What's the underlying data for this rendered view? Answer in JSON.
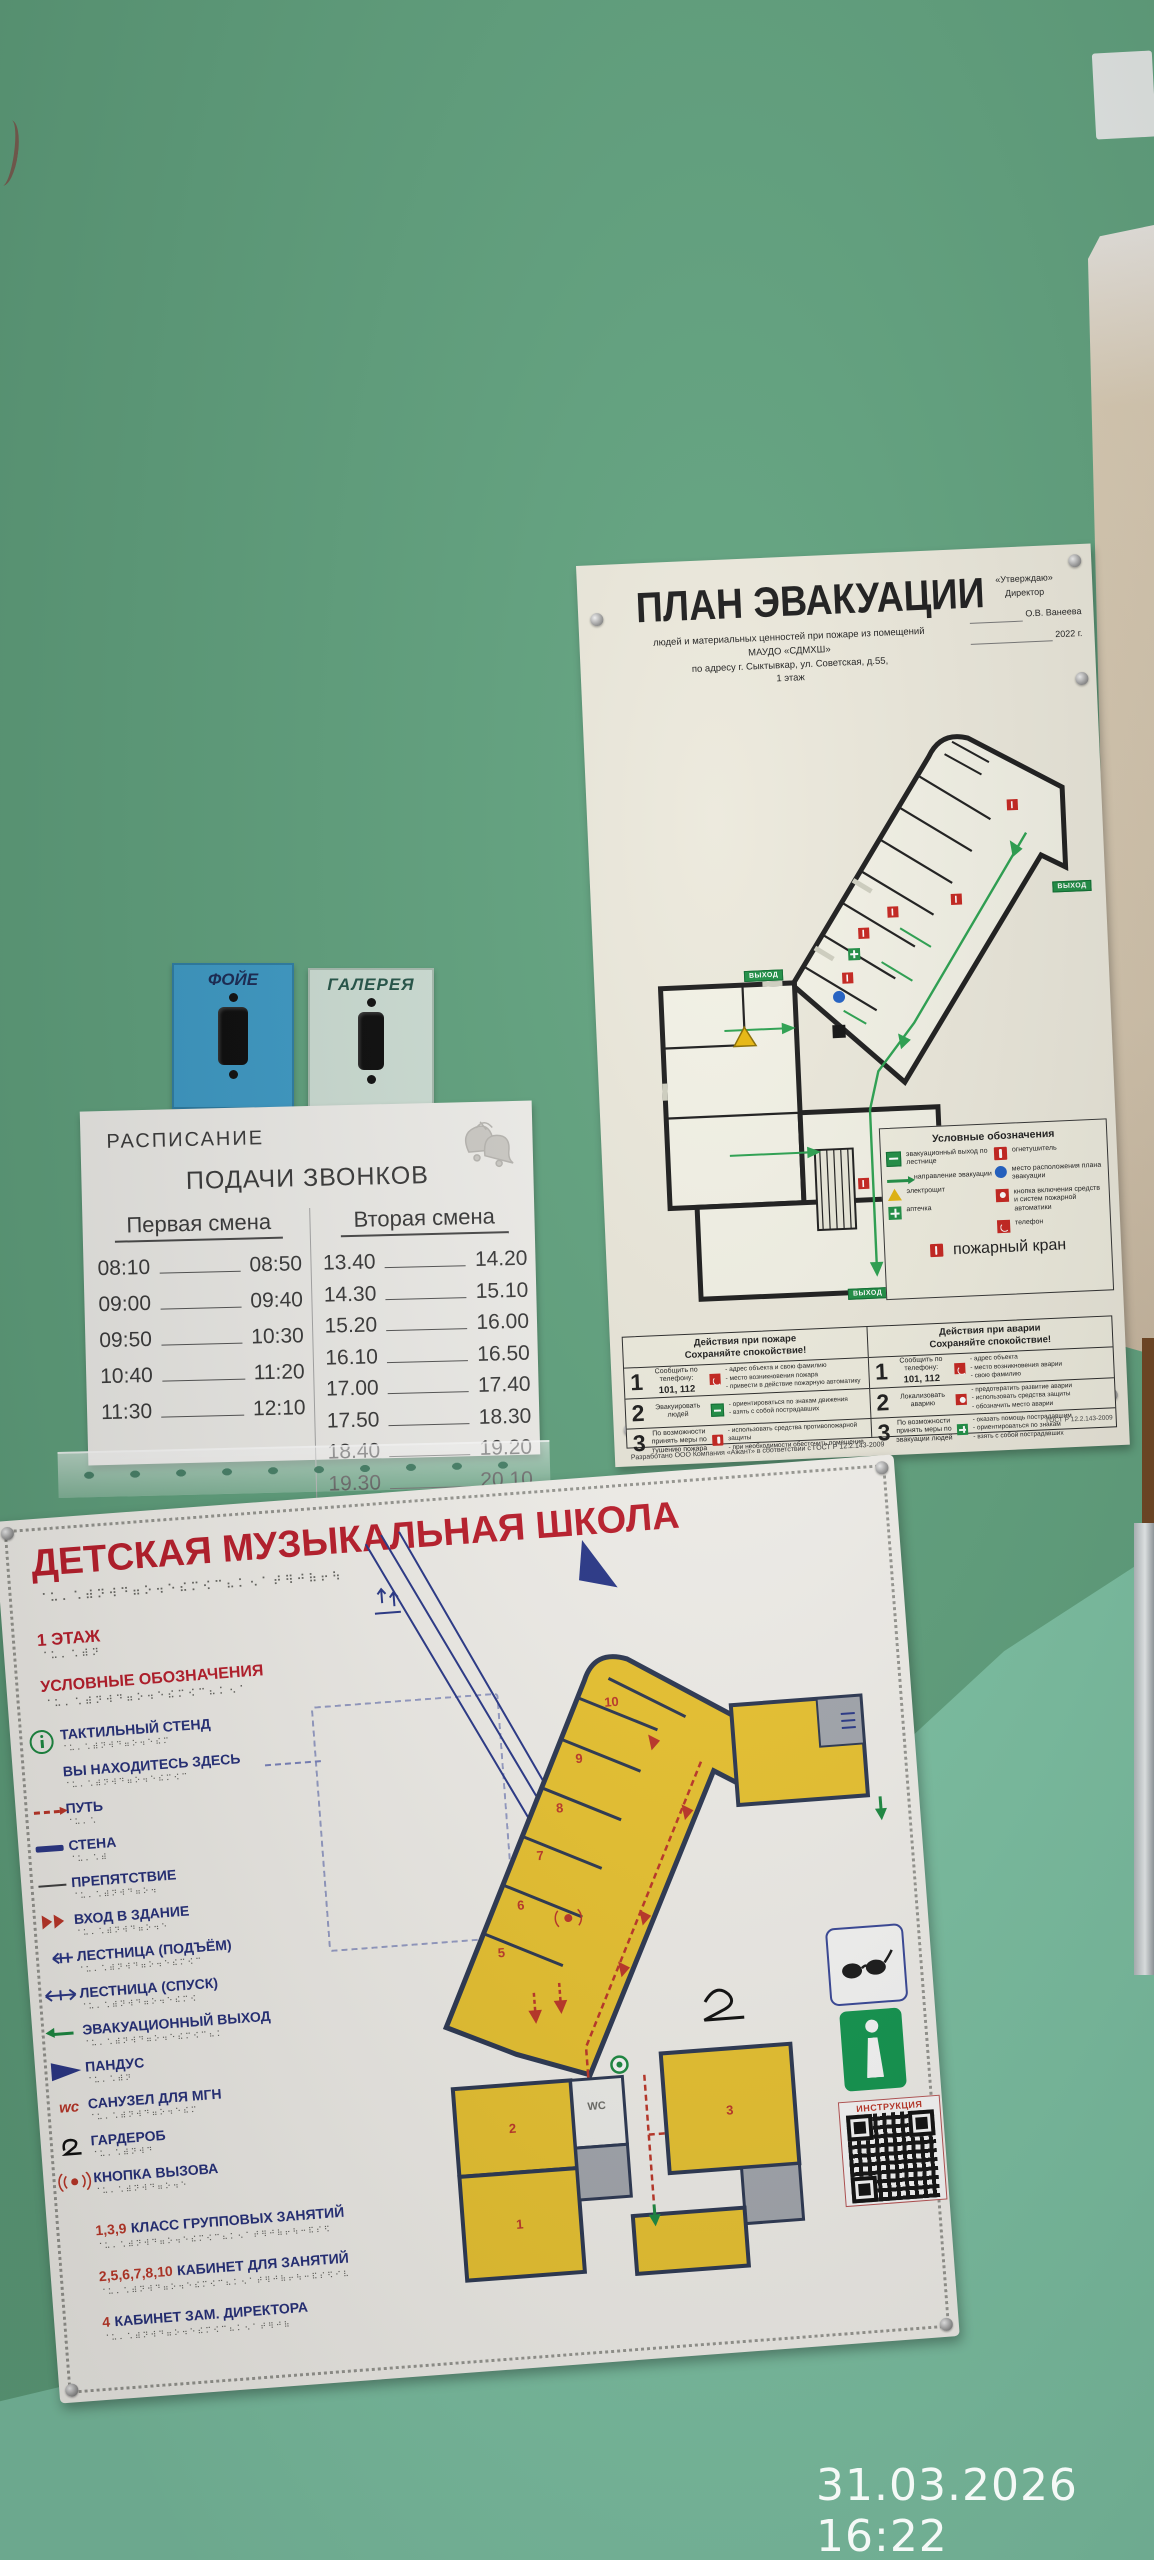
{
  "camera": {
    "timestamp": "31.03.2026 16:22"
  },
  "switches": {
    "left": "ФОЙЕ",
    "right": "ГАЛЕРЕЯ"
  },
  "bell_schedule": {
    "title1": "РАСПИСАНИЕ",
    "title2": "ПОДАЧИ ЗВОНКОВ",
    "shift1": {
      "header": "Первая смена",
      "rows": [
        [
          "08:10",
          "08:50"
        ],
        [
          "09:00",
          "09:40"
        ],
        [
          "09:50",
          "10:30"
        ],
        [
          "10:40",
          "11:20"
        ],
        [
          "11:30",
          "12:10"
        ]
      ]
    },
    "shift2": {
      "header": "Вторая смена",
      "rows": [
        [
          "13.40",
          "14.20"
        ],
        [
          "14.30",
          "15.10"
        ],
        [
          "15.20",
          "16.00"
        ],
        [
          "16.10",
          "16.50"
        ],
        [
          "17.00",
          "17.40"
        ],
        [
          "17.50",
          "18.30"
        ],
        [
          "18.40",
          "19.20"
        ],
        [
          "19.30",
          "20.10"
        ]
      ]
    }
  },
  "evac_plan": {
    "title": "ПЛАН ЭВАКУАЦИИ",
    "subtitle1": "людей и материальных ценностей при пожаре из помещений",
    "subtitle2": "МАУДО «СДМХШ»",
    "subtitle3": "по адресу г. Сыктывкар, ул. Советская, д.55,",
    "subtitle4": "1 этаж",
    "approve1": "«Утверждаю»",
    "approve2": "Директор",
    "approve3": "О.В. Ванеева",
    "approve4": "2022 г.",
    "exit_badge": "ВЫХОД",
    "legend": {
      "title": "Условные обозначения",
      "items_left": [
        "эвакуационный выход по лестнице",
        "направление эвакуации",
        "электрощит",
        "аптечка"
      ],
      "items_right": [
        "огнетушитель",
        "место расположения плана эвакуации",
        "кнопка включения средств и систем пожарной автоматики",
        "телефон"
      ],
      "item_bottom": "пожарный кран"
    },
    "fire": {
      "title": "Действия при пожаре",
      "subtitle": "Сохраняйте спокойствие!",
      "rows": [
        {
          "n": "1",
          "action": "Сообщить по телефону:",
          "phone": "101, 112",
          "details": "- адрес объекта и свою фамилию\n- место возникновения пожара\n- привести в действие пожарную автоматику"
        },
        {
          "n": "2",
          "action": "Эвакуировать людей",
          "phone": "",
          "details": "- ориентироваться по знакам движения\n- взять с собой пострадавших"
        },
        {
          "n": "3",
          "action": "По возможности принять меры по тушению пожара",
          "phone": "",
          "details": "- использовать средства противопожарной защиты\n- при необходимости обесточить помещение"
        }
      ]
    },
    "accident": {
      "title": "Действия при аварии",
      "subtitle": "Сохраняйте спокойствие!",
      "rows": [
        {
          "n": "1",
          "action": "Сообщить по телефону:",
          "phone": "101, 112",
          "details": "- адрес объекта\n- место возникновения аварии\n- свою фамилию"
        },
        {
          "n": "2",
          "action": "Локализовать аварию",
          "phone": "",
          "details": "- предотвратить развитие аварии\n- использовать средства защиты\n- обозначить место аварии"
        },
        {
          "n": "3",
          "action": "По возможности принять меры по эвакуации людей",
          "phone": "",
          "details": "- оказать помощь пострадавшим\n- ориентироваться по знакам\n- взять с собой пострадавших"
        }
      ]
    },
    "footer_left": "Разработано ООО Компания «Ажант» в соответствии с ГОСТ Р 12.2.143-2009",
    "footer_right": "ГОСТ Р 12.2.143-2009"
  },
  "tactile": {
    "title": "ДЕТСКАЯ МУЗЫКАЛЬНАЯ ШКОЛА",
    "floor": "1 ЭТАЖ",
    "legend_title": "УСЛОВНЫЕ ОБОЗНАЧЕНИЯ",
    "items": [
      "ТАКТИЛЬНЫЙ СТЕНД",
      "ВЫ НАХОДИТЕСЬ ЗДЕСЬ",
      "ПУТЬ",
      "СТЕНА",
      "ПРЕПЯТСТВИЕ",
      "ВХОД В ЗДАНИЕ",
      "ЛЕСТНИЦА (ПОДЪЁМ)",
      "ЛЕСТНИЦА (СПУСК)",
      "ЭВАКУАЦИОННЫЙ ВЫХОД",
      "ПАНДУС",
      "САНУЗЕЛ ДЛЯ МГН",
      "ГАРДЕРОБ",
      "КНОПКА ВЫЗОВА"
    ],
    "wc_icon": "wc",
    "rooms": [
      {
        "nums": "1,3,9",
        "label": "КЛАСС ГРУППОВЫХ ЗАНЯТИЙ"
      },
      {
        "nums": "2,5,6,7,8,10",
        "label": "КАБИНЕТ ДЛЯ ЗАНЯТИЙ"
      },
      {
        "nums": "4",
        "label": "КАБИНЕТ ЗАМ. ДИРЕКТОРА"
      }
    ],
    "map_rooms": [
      "10",
      "9",
      "8",
      "7",
      "6",
      "5",
      "3",
      "2",
      "1",
      "WC"
    ],
    "qr_label": "ИНСТРУКЦИЯ"
  }
}
